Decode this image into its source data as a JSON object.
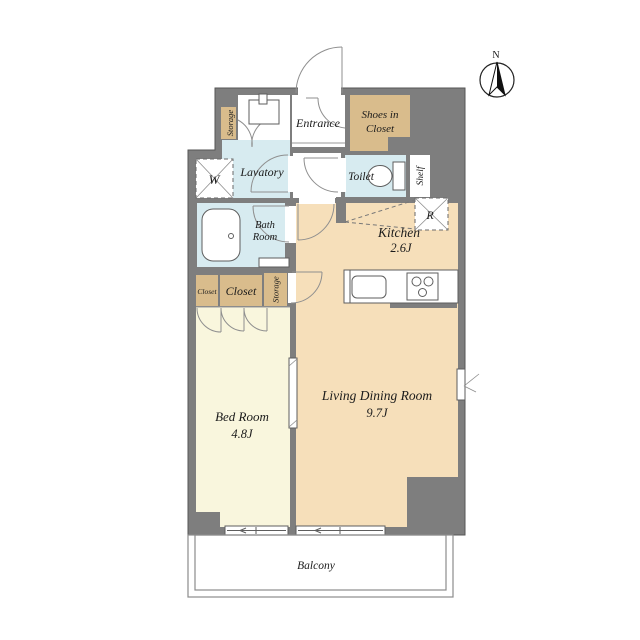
{
  "floor_plan": {
    "compass": {
      "north": "N"
    },
    "labels": {
      "entrance": "Entrance",
      "shoes_in_closet_1": "Shoes in",
      "shoes_in_closet_2": "Closet",
      "storage_upper": "Storage",
      "lavatory": "Lavatory",
      "washing_machine": "W",
      "toilet": "Toilet",
      "shelf": "Shelf",
      "refrigerator": "R",
      "kitchen": "Kitchen",
      "kitchen_size": "2.6J",
      "bath_1": "Bath",
      "bath_2": "Room",
      "closet_small": "Closet",
      "closet_large": "Closet",
      "storage_middle": "Storage",
      "bed_room": "Bed Room",
      "bed_room_size": "4.8J",
      "living_dining": "Living Dining Room",
      "living_dining_size": "9.7J",
      "balcony": "Balcony"
    },
    "colors": {
      "wall": "#7e7e7e",
      "closet_tan": "#d9bc8c",
      "floor_tan": "#f6dfba",
      "floor_cream": "#f9f6dd",
      "wet_area_blue": "#d7ebf0",
      "fixture_white": "#ffffff"
    }
  }
}
